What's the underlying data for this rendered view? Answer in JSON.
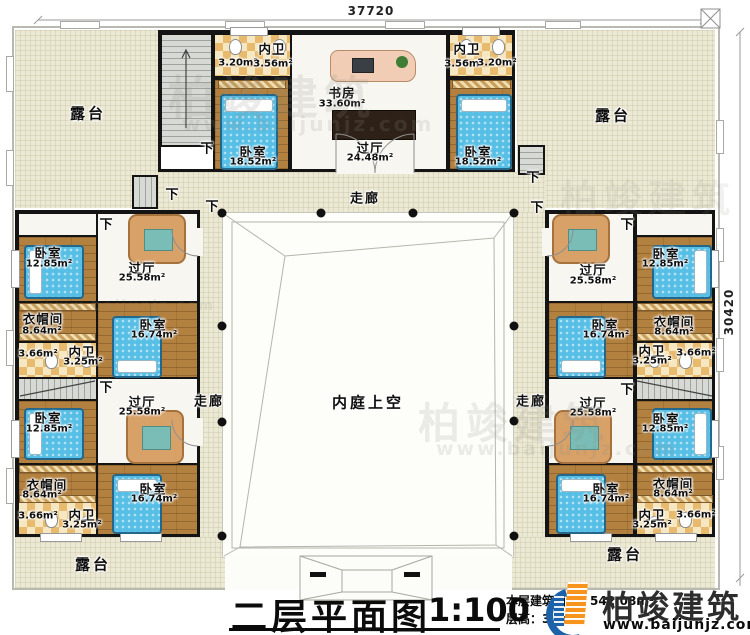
{
  "dimensions": {
    "top": "37720",
    "right": "30420"
  },
  "labels": {
    "terrace": "露台",
    "corridor": "走廊",
    "courtyard_void": "内庭上空",
    "down": "下"
  },
  "top_block": {
    "bath_left": {
      "name": "内卫",
      "area_a": "3.20m²",
      "area_b": "3.56m²"
    },
    "bath_right": {
      "name": "内卫",
      "area_a": "3.56m²",
      "area_b": "3.20m²"
    },
    "study": {
      "name": "书房",
      "area": "33.60m²"
    },
    "hall": {
      "name": "过厅",
      "area": "24.48m²"
    },
    "bedroom_left": {
      "name": "卧室",
      "area": "18.52m²"
    },
    "bedroom_right": {
      "name": "卧室",
      "area": "18.52m²"
    }
  },
  "clusters": [
    {
      "id": "left-upper",
      "bedroom_small": {
        "name": "卧室",
        "area": "12.85m²"
      },
      "hall": {
        "name": "过厅",
        "area": "25.58m²"
      },
      "cloak": {
        "name": "衣帽间",
        "area": "8.64m²"
      },
      "bath": {
        "name": "内卫",
        "area": "3.25m²",
        "area_side": "3.66m²"
      },
      "bedroom_large": {
        "name": "卧室",
        "area": "16.74m²"
      }
    },
    {
      "id": "left-lower",
      "bedroom_small": {
        "name": "卧室",
        "area": "12.85m²"
      },
      "hall": {
        "name": "过厅",
        "area": "25.58m²"
      },
      "cloak": {
        "name": "衣帽间",
        "area": "8.64m²"
      },
      "bath": {
        "name": "内卫",
        "area": "3.25m²",
        "area_side": "3.66m²"
      },
      "bedroom_large": {
        "name": "卧室",
        "area": "16.74m²"
      }
    },
    {
      "id": "right-upper",
      "bedroom_small": {
        "name": "卧室",
        "area": "12.85m²"
      },
      "hall": {
        "name": "过厅",
        "area": "25.58m²"
      },
      "cloak": {
        "name": "衣帽间",
        "area": "8.64m²"
      },
      "bath": {
        "name": "内卫",
        "area": "3.25m²",
        "area_side": "3.66m²"
      },
      "bedroom_large": {
        "name": "卧室",
        "area": "16.74m²"
      }
    },
    {
      "id": "right-lower",
      "bedroom_small": {
        "name": "卧室",
        "area": "12.85m²"
      },
      "hall": {
        "name": "过厅",
        "area": "25.58m²"
      },
      "cloak": {
        "name": "衣帽间",
        "area": "8.64m²"
      },
      "bath": {
        "name": "内卫",
        "area": "3.25m²",
        "area_side": "3.66m²"
      },
      "bedroom_large": {
        "name": "卧室",
        "area": "16.74m²"
      }
    }
  ],
  "title_block": {
    "title": "二层平面图",
    "scale": "1:100",
    "area_line": "本层建筑面积：542.08m²",
    "height_line": "层高：3.6m"
  },
  "logo": {
    "brand": "柏竣建筑",
    "url": "www.baijunjz.com"
  },
  "watermark": {
    "brand": "柏竣建筑",
    "url": "www.baijunjz.com"
  },
  "colors": {
    "wall": "#141414",
    "terrace": "#ebe8d3",
    "wood": "#b3813f",
    "checker_dark": "#e7ba6e",
    "checker_light": "#f5e7c2",
    "bed": "#57bfe5",
    "logo_blue": "#1b62ab",
    "logo_orange": "#f7941d"
  }
}
